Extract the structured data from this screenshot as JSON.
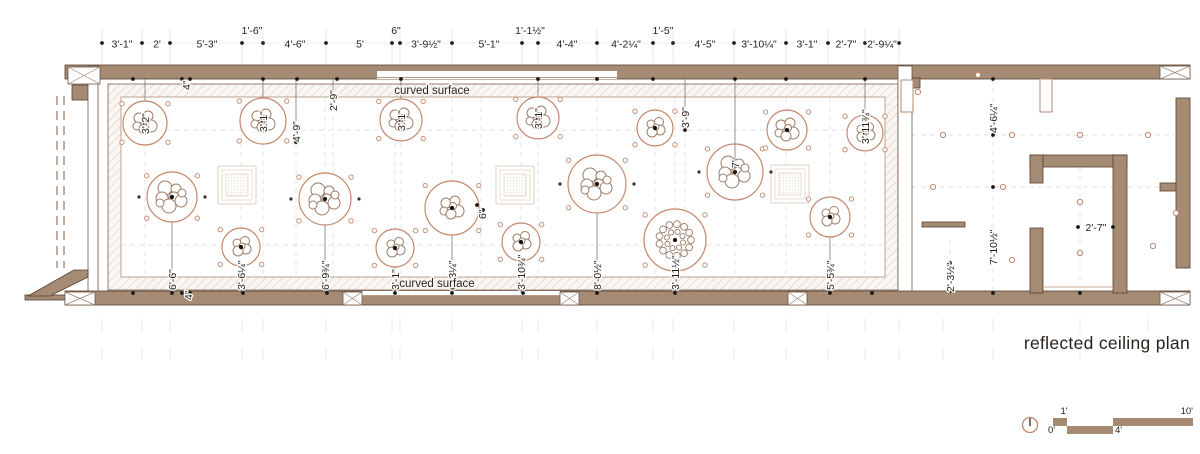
{
  "title": "reflected ceiling plan",
  "curved_surface": {
    "top": "curved surface",
    "bottom": "curved surface"
  },
  "top_dims": {
    "baseline": [
      {
        "t": "3'-1\"",
        "x": 122
      },
      {
        "t": "2'",
        "x": 157
      },
      {
        "t": "5'-3\"",
        "x": 207
      },
      {
        "t": "4'-6\"",
        "x": 295
      },
      {
        "t": "5'",
        "x": 360
      },
      {
        "t": "3'-9½\"",
        "x": 426
      },
      {
        "t": "5'-1\"",
        "x": 489
      },
      {
        "t": "4'-4\"",
        "x": 567
      },
      {
        "t": "4'-2¼\"",
        "x": 626
      },
      {
        "t": "4'-5\"",
        "x": 705
      },
      {
        "t": "3'-10¼\"",
        "x": 759
      },
      {
        "t": "3'-1\"",
        "x": 807
      },
      {
        "t": "2'-7\"",
        "x": 846
      },
      {
        "t": "2'-9¼\"",
        "x": 882
      }
    ],
    "raised": [
      {
        "t": "1'-6\"",
        "x": 252
      },
      {
        "t": "6\"",
        "x": 396
      },
      {
        "t": "1'-1½\"",
        "x": 530
      },
      {
        "t": "1'-5\"",
        "x": 663
      }
    ],
    "dots": [
      102,
      142,
      170,
      242,
      263,
      326,
      392,
      400,
      452,
      522,
      538,
      597,
      653,
      673,
      734,
      786,
      828,
      865,
      899
    ]
  },
  "hall_dims": {
    "d49": "4'-9\"",
    "d29": "2'-9\"",
    "d39": "3'-9\"",
    "d7": "7'",
    "d4_top": "4\"",
    "d4_bottom": "4\"",
    "d6": "6\""
  },
  "wing_dims": {
    "d464": "4'-6¼\"",
    "d7102": "7'-10½\"",
    "d232": "2'-3½\"",
    "d27": "2'-7\""
  },
  "fixtures": [
    {
      "x": 145,
      "y": 123,
      "r": 22,
      "label": "3'-2\"",
      "side": "top",
      "type": "m"
    },
    {
      "x": 263,
      "y": 121,
      "r": 23,
      "label": "3'-1\"",
      "side": "top",
      "type": "m"
    },
    {
      "x": 401,
      "y": 120,
      "r": 21,
      "label": "3'-1\"",
      "side": "top",
      "type": "m"
    },
    {
      "x": 538,
      "y": 118,
      "r": 21,
      "label": "3'-1\"",
      "side": "top",
      "type": "m"
    },
    {
      "x": 655,
      "y": 128,
      "r": 18,
      "label": "",
      "side": "",
      "type": "s"
    },
    {
      "x": 735,
      "y": 172,
      "r": 28,
      "label": "",
      "side": "",
      "type": "l"
    },
    {
      "x": 787,
      "y": 130,
      "r": 20,
      "label": "",
      "side": "",
      "type": "m"
    },
    {
      "x": 865,
      "y": 133,
      "r": 18,
      "label": "3'-11¾\"",
      "side": "top",
      "type": "s"
    },
    {
      "x": 172,
      "y": 197,
      "r": 25,
      "label": "6'-6\"",
      "side": "bottom",
      "type": "l"
    },
    {
      "x": 241,
      "y": 247,
      "r": 19,
      "label": "3'-6¼\"",
      "side": "bottom",
      "type": "s"
    },
    {
      "x": 325,
      "y": 199,
      "r": 26,
      "label": "6'-9¾\"",
      "side": "bottom",
      "type": "l"
    },
    {
      "x": 395,
      "y": 248,
      "r": 19,
      "label": "3'-1\"",
      "side": "bottom",
      "type": "s"
    },
    {
      "x": 452,
      "y": 208,
      "r": 27,
      "label": "6'-3¼\"",
      "side": "bottom",
      "type": "m"
    },
    {
      "x": 521,
      "y": 242,
      "r": 19,
      "label": "3'-10¾\"",
      "side": "bottom",
      "type": "s"
    },
    {
      "x": 597,
      "y": 184,
      "r": 29,
      "label": "8'-0½\"",
      "side": "bottom",
      "type": "l"
    },
    {
      "x": 675,
      "y": 240,
      "r": 31,
      "label": "3'-11½\"",
      "side": "bottom",
      "type": "dot"
    },
    {
      "x": 830,
      "y": 217,
      "r": 20,
      "label": "5'-5¾\"",
      "side": "bottom",
      "type": "s"
    }
  ],
  "scale_bar": {
    "zero": "0'",
    "one": "1'",
    "four": "4'",
    "ten": "10'"
  },
  "colors": {
    "wall": "#a58a74",
    "wall_outline": "#54402f",
    "fixture": "#c4876a",
    "text": "#211c18"
  }
}
